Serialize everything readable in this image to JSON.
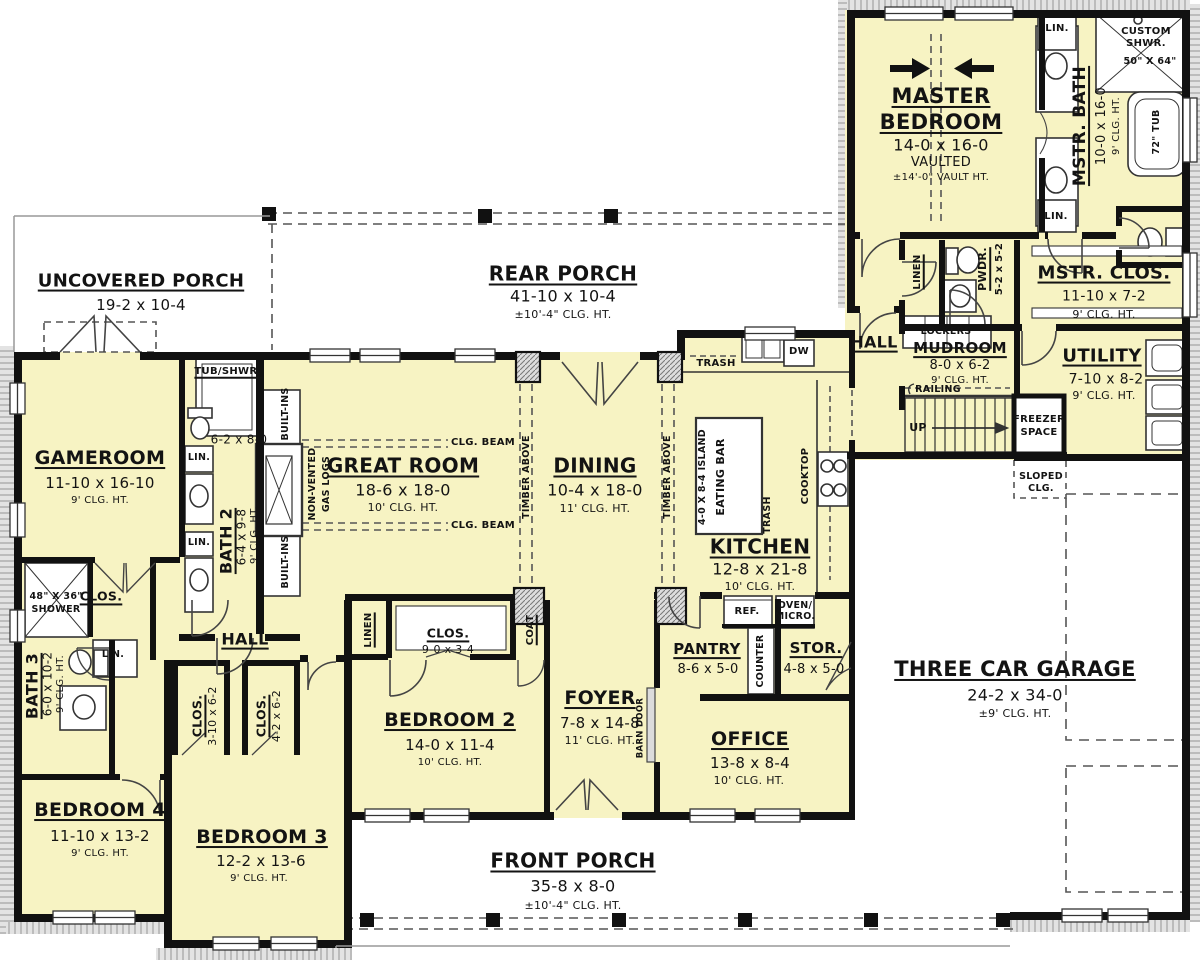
{
  "palette": {
    "room_fill": "#f7f3c3",
    "wall": "#111111",
    "paper": "#ffffff",
    "band": "#e3e3e3",
    "band_tick": "#9b9b9b",
    "dash": "#555555"
  },
  "plan": {
    "uncovered_porch": {
      "name": "UNCOVERED PORCH",
      "dims": "19-2 x 10-4"
    },
    "rear_porch": {
      "name": "REAR PORCH",
      "dims": "41-10 x 10-4",
      "clg": "±10'-4\" CLG. HT."
    },
    "front_porch": {
      "name": "FRONT PORCH",
      "dims": "35-8 x 8-0",
      "clg": "±10'-4\" CLG. HT."
    },
    "garage": {
      "name": "THREE CAR GARAGE",
      "dims": "24-2 x 34-0",
      "clg": "±9' CLG. HT."
    },
    "master_bedroom": {
      "name_l1": "MASTER",
      "name_l2": "BEDROOM",
      "dims": "14-0 x 16-0",
      "note": "VAULTED",
      "clg": "±14'-0\" VAULT HT."
    },
    "mstr_bath": {
      "name": "MSTR. BATH",
      "dims": "10-0 x 16-0",
      "clg": "9' CLG. HT."
    },
    "custom_shwr": {
      "l1": "CUSTOM",
      "l2": "SHWR.",
      "dims": "50\" X 64\""
    },
    "tub": {
      "name": "72\" TUB"
    },
    "lin": "LIN.",
    "mstr_clos": {
      "name": "MSTR. CLOS.",
      "dims": "11-10 x 7-2",
      "clg": "9' CLG. HT."
    },
    "linen_master": "LINEN",
    "pwdr": {
      "name": "PWDR.",
      "dims": "5-2 x 5-2"
    },
    "hall_master": "HALL",
    "lockers": "LOCKERS",
    "mudroom": {
      "name": "MUDROOM",
      "dims": "8-0 x 6-2",
      "clg": "9' CLG. HT."
    },
    "railing": "RAILING",
    "up": "UP",
    "utility": {
      "name": "UTILITY",
      "dims": "7-10 x 8-2",
      "clg": "9' CLG. HT."
    },
    "freezer": {
      "l1": "FREEZER",
      "l2": "SPACE"
    },
    "sloped": {
      "l1": "SLOPED",
      "l2": "CLG."
    },
    "kitchen": {
      "name": "KITCHEN",
      "dims": "12-8 x 21-8",
      "clg": "10' CLG. HT."
    },
    "island": "4-0 X 8-4 ISLAND",
    "eating_bar": "EATING BAR",
    "cooktop": "COOKTOP",
    "trash": "TRASH",
    "dw": "DW",
    "ref": "REF.",
    "oven": {
      "l1": "OVEN/",
      "l2": "MICRO."
    },
    "pantry": {
      "name": "PANTRY",
      "dims": "8-6 x 5-0"
    },
    "counter": "COUNTER",
    "stor": {
      "name": "STOR.",
      "dims": "4-8 x 5-0"
    },
    "dining": {
      "name": "DINING",
      "dims": "10-4 x 18-0",
      "clg": "11' CLG. HT."
    },
    "great_room": {
      "name": "GREAT ROOM",
      "dims": "18-6 x 18-0",
      "clg": "10' CLG. HT."
    },
    "clg_beam": "CLG. BEAM",
    "timber_above": "TIMBER ABOVE",
    "built_ins": "BUILT-INS",
    "gas_logs": {
      "l1": "NON-VENTED",
      "l2": "GAS LOGS"
    },
    "gameroom": {
      "name": "GAMEROOM",
      "dims": "11-10 x 16-10",
      "clg": "9' CLG. HT."
    },
    "tub_shwr": "TUB/SHWR.",
    "bath2": {
      "name": "BATH 2",
      "dims": "6-4 x 9-8",
      "clg": "9' CLG. HT.",
      "toilet_dims": "6-2 x 8-0"
    },
    "bath3": {
      "name": "BATH 3",
      "dims": "6-0 x 10-2",
      "clg": "9' CLG. HT."
    },
    "shower48": {
      "l1": "48\" X 36\"",
      "l2": "SHOWER"
    },
    "clos": "CLOS.",
    "hall_bed": "HALL",
    "clos3": {
      "name": "CLOS.",
      "dims": "3-10 x 6-2"
    },
    "clos4": {
      "name": "CLOS.",
      "dims": "4-2 x 6-2"
    },
    "bedroom4": {
      "name": "BEDROOM 4",
      "dims": "11-10 x 13-2",
      "clg": "9' CLG. HT."
    },
    "bedroom3": {
      "name": "BEDROOM 3",
      "dims": "12-2 x 13-6",
      "clg": "9' CLG. HT."
    },
    "bedroom2": {
      "name": "BEDROOM 2",
      "dims": "14-0 x 11-4",
      "clg": "10' CLG. HT."
    },
    "linen2": "LINEN",
    "clos9": {
      "name": "CLOS.",
      "dims": "9-0 x 3-4"
    },
    "coat": "COAT",
    "foyer": {
      "name": "FOYER",
      "dims": "7-8 x 14-8",
      "clg": "11' CLG. HT."
    },
    "barn_door": "BARN DOOR",
    "office": {
      "name": "OFFICE",
      "dims": "13-8 x 8-4",
      "clg": "10' CLG. HT."
    }
  }
}
